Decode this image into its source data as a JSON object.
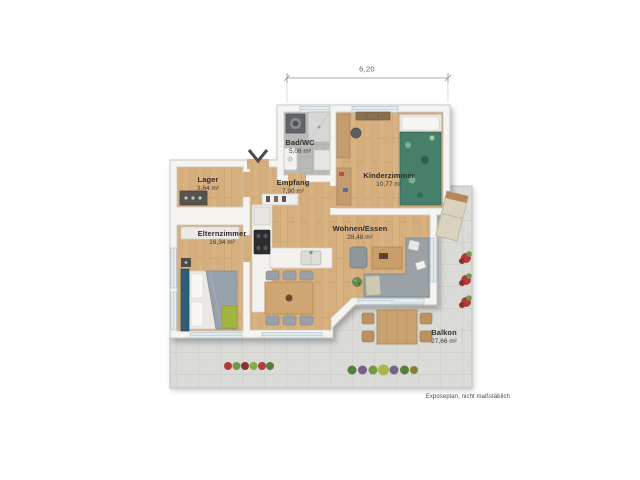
{
  "plan": {
    "dimension_label": "6,20",
    "footnote": "Exposeplan, nicht maßstäblich",
    "rooms": [
      {
        "id": "lager",
        "name": "Lager",
        "area": "3,64 m²"
      },
      {
        "id": "elternzimmer",
        "name": "Elternzimmer",
        "area": "16,34 m²"
      },
      {
        "id": "empfang",
        "name": "Empfang",
        "area": "7,90 m²"
      },
      {
        "id": "bad-wc",
        "name": "Bad/WC",
        "area": "5,08 m²"
      },
      {
        "id": "kinderzimmer",
        "name": "Kinderzimmer",
        "area": "10,77 m²"
      },
      {
        "id": "wohnen-essen",
        "name": "Wohnen/Essen",
        "area": "28,48 m²"
      },
      {
        "id": "balkon",
        "name": "Balkon",
        "area": "27,66 m²"
      }
    ],
    "colors": {
      "wall": "#f5f4f1",
      "wood_floor": "#d8b183",
      "terrace_tile": "#dadad7",
      "bath_tile": "#b9bab8",
      "window_glass": "#e3edf0",
      "sofa_gray": "#9aa2a8",
      "parents_bed_blue": "#2f5d77",
      "kids_bed_green": "#47806a",
      "pillow_green": "#a4b53f",
      "flower_red": "#b5393c"
    }
  }
}
